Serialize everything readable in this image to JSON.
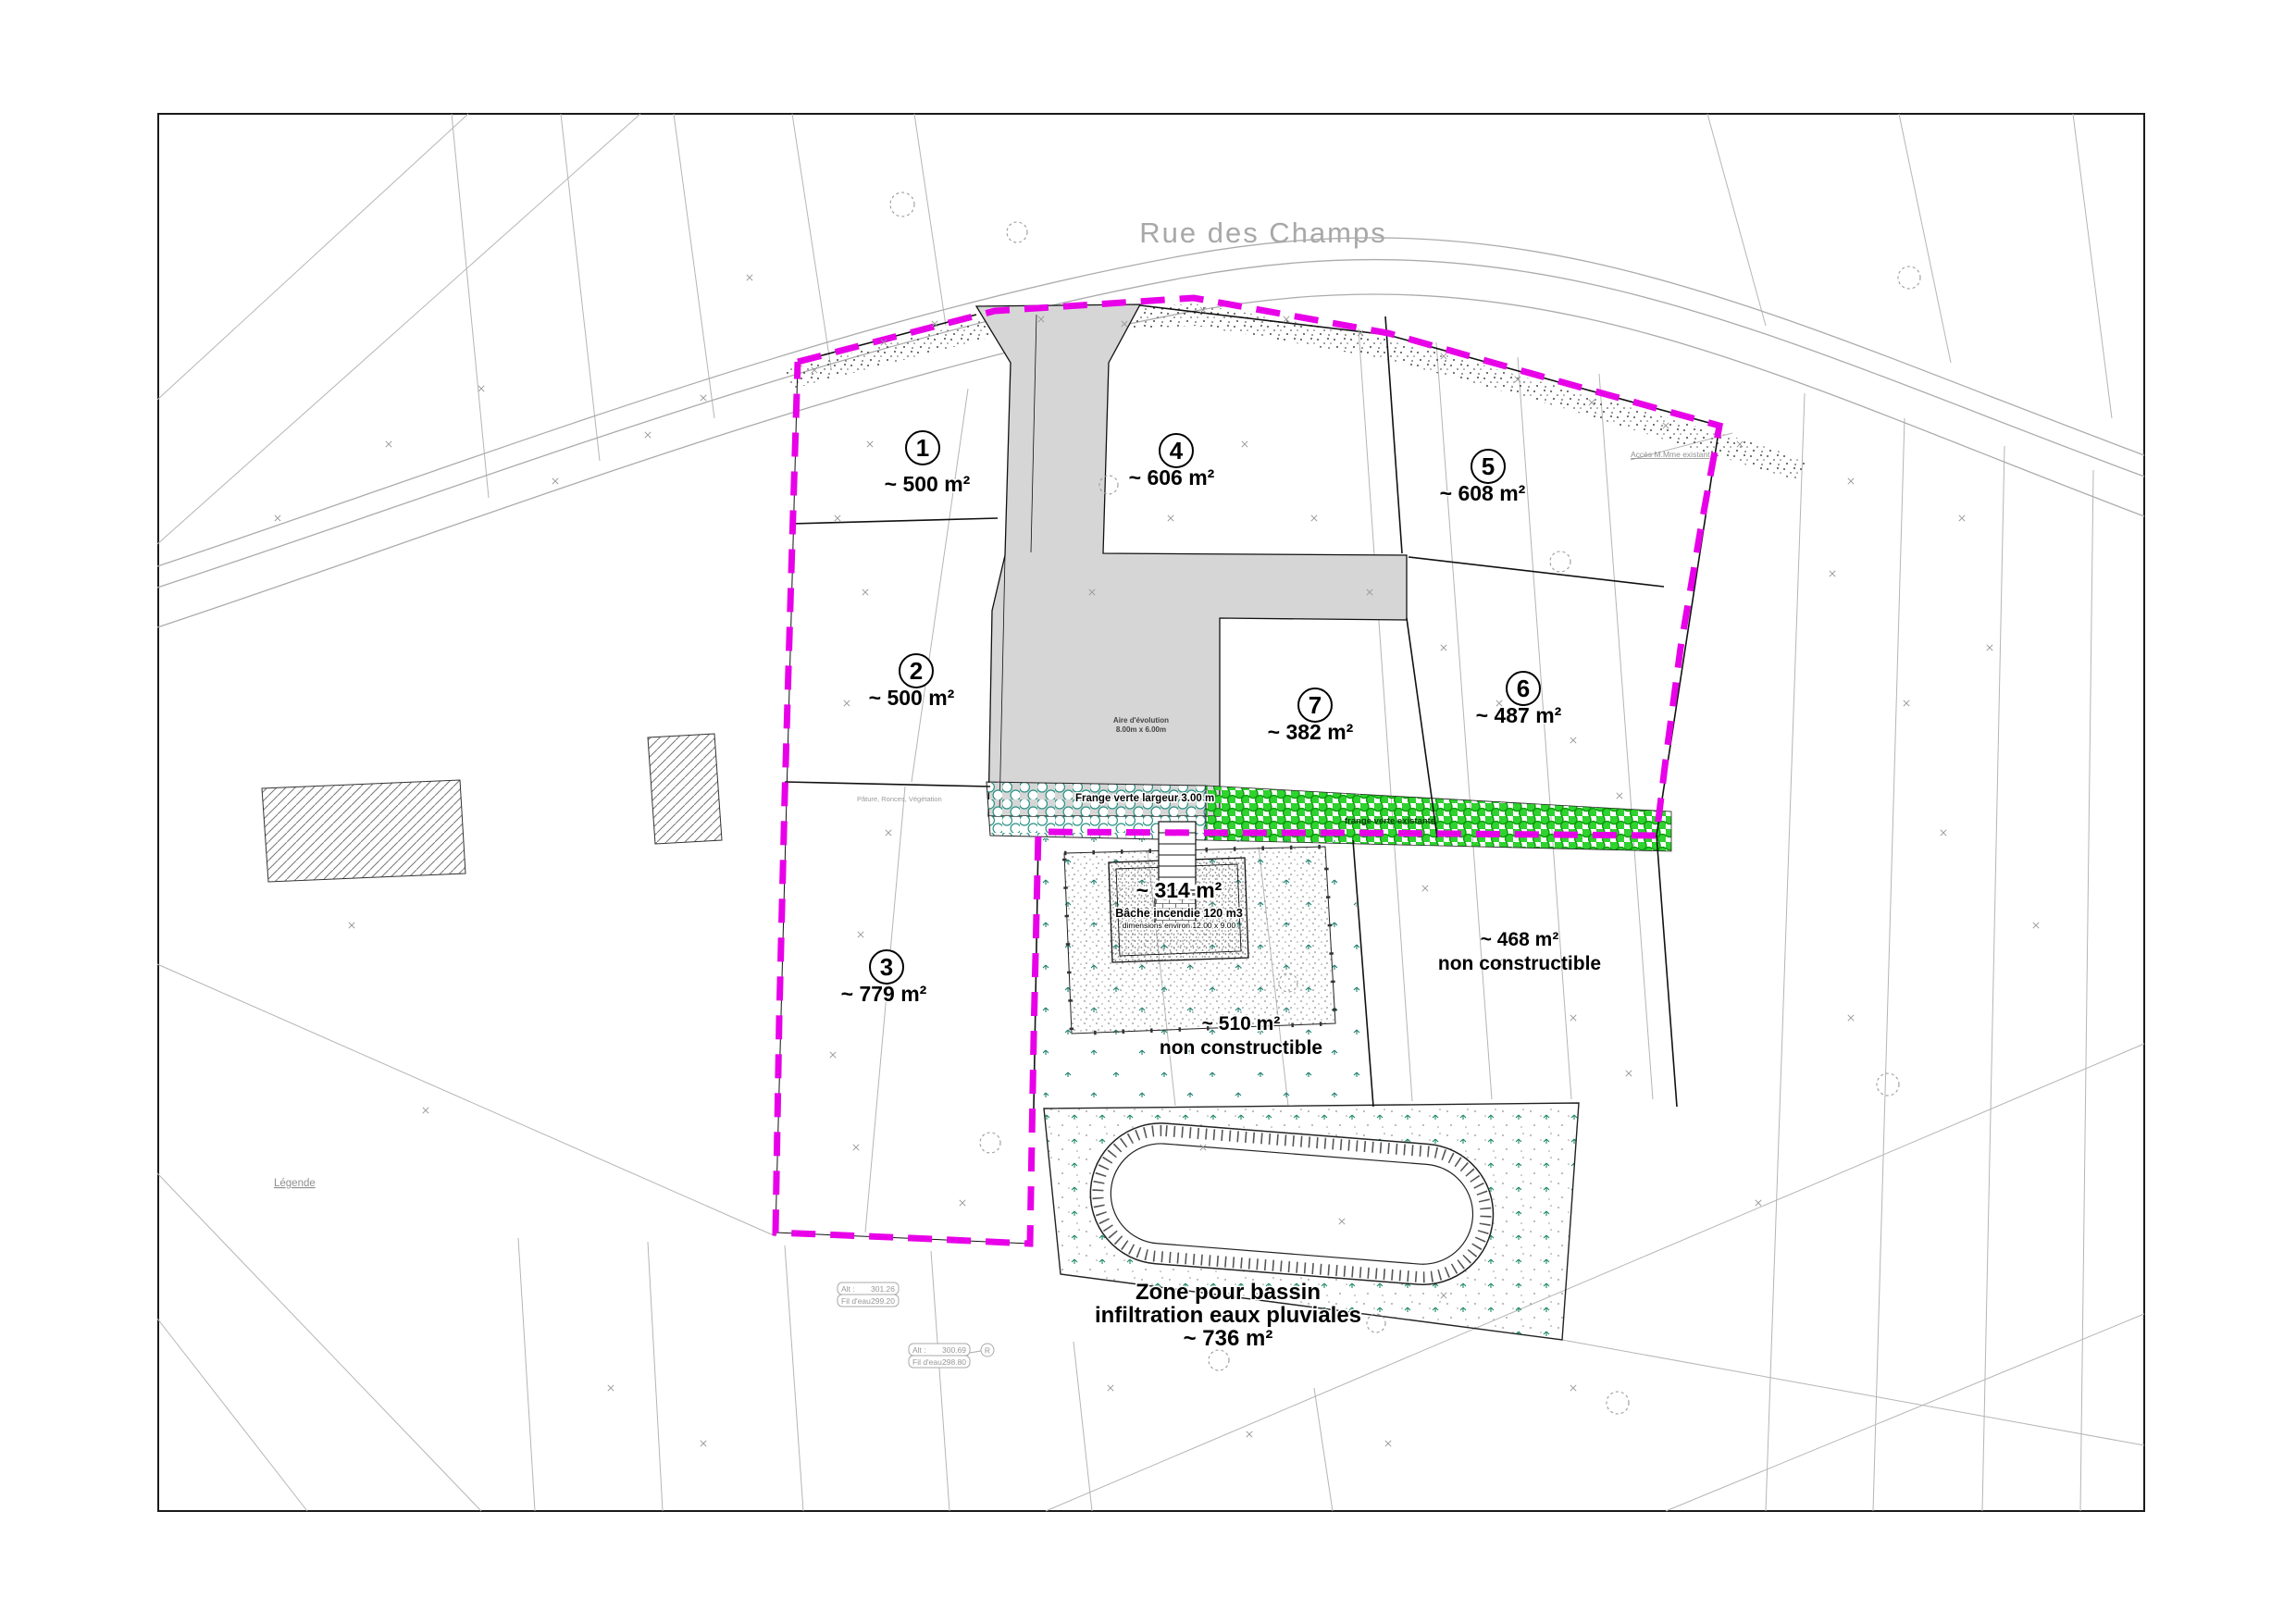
{
  "plan": {
    "street_label": "Rue des Champs",
    "legend_label": "Légende",
    "terrain_note": "Pâture, Ronces, Végétation",
    "access_note": "Accès M.Mme existant",
    "parcels": [
      {
        "num": "1",
        "area": "~ 500 m²"
      },
      {
        "num": "2",
        "area": "~ 500 m²"
      },
      {
        "num": "3",
        "area": "~ 779 m²"
      },
      {
        "num": "4",
        "area": "~ 606 m²"
      },
      {
        "num": "5",
        "area": "~ 608 m²"
      },
      {
        "num": "6",
        "area": "~ 487 m²"
      },
      {
        "num": "7",
        "area": "~ 382 m²"
      }
    ],
    "fire_tank": {
      "area": "~ 314 m²",
      "label": "Bâche incendie 120 m3",
      "dims": "dimensions environ 12.00 x 9.00"
    },
    "non_buildable_east": {
      "area": "~ 468 m²",
      "label": "non constructible"
    },
    "non_buildable_center": {
      "area": "~ 510 m²",
      "label": "non constructible"
    },
    "basin": {
      "line1": "Zone pour bassin",
      "line2": "infiltration eaux pluviales",
      "area": "~ 736 m²"
    },
    "green_strip_label": "Frange verte largeur 3.00 m",
    "green_hedge_label": "frange verte existante",
    "turning_area": {
      "line1": "Aire d'évolution",
      "line2": "8.00m x 6.00m"
    },
    "levels": [
      {
        "alt_label": "Alt :",
        "alt": "301.26",
        "fe_label": "Fil d'eau :",
        "fe": "299.20"
      },
      {
        "alt_label": "Alt :",
        "alt": "300.69",
        "fe_label": "Fil d'eau :",
        "fe": "298.80"
      }
    ],
    "manhole_symbol": "R"
  },
  "colors": {
    "boundary": "#e800e8",
    "green_hedge": "#2fd32f",
    "teal": "#2a9183",
    "road_fill": "#d6d6d6",
    "cadastral_line": "#b5b5b5"
  }
}
